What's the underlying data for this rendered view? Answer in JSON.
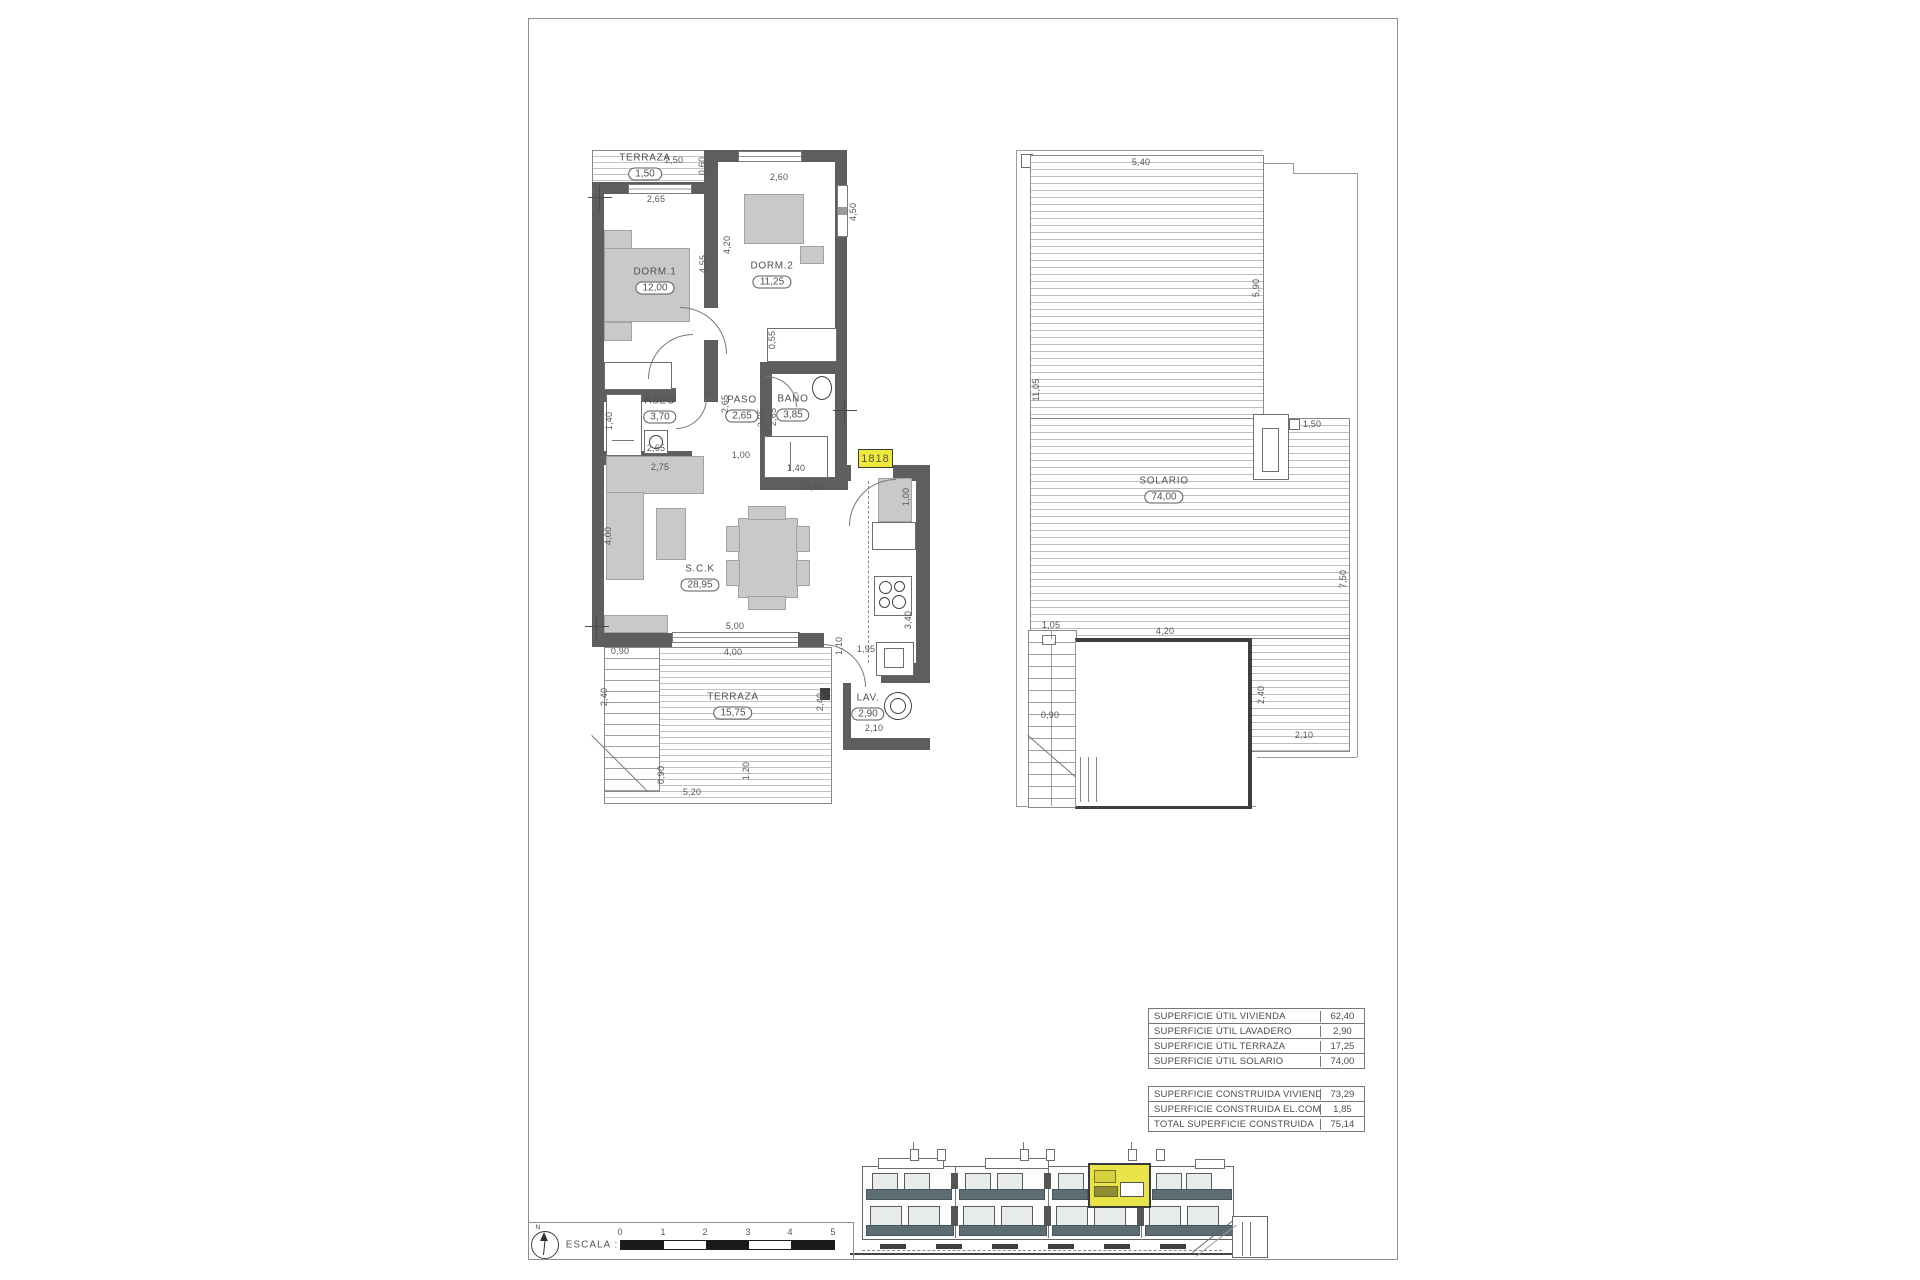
{
  "floor_plan": {
    "rooms": {
      "terraza_top": {
        "name": "TERRAZA",
        "area": "1,50"
      },
      "dorm1": {
        "name": "DORM.1",
        "area": "12,00"
      },
      "dorm2": {
        "name": "DORM.2",
        "area": "11,25"
      },
      "aseo": {
        "name": "ASEO",
        "area": "3,70"
      },
      "paso": {
        "name": "PASO",
        "area": "2,65"
      },
      "bano": {
        "name": "BAÑO",
        "area": "3,85"
      },
      "sck": {
        "name": "S.C.K",
        "area": "28,95"
      },
      "terraza_main": {
        "name": "TERRAZA",
        "area": "15,75"
      },
      "lav": {
        "name": "LAV.",
        "area": "2,90"
      }
    },
    "unit_badge": "1818",
    "dims": {
      "terraza_w": "2,50",
      "terraza_d": "0,60",
      "dorm1_window": "2,65",
      "dorm1_depth": "4,55",
      "dorm2_depth": "4,20",
      "dorm2_w": "2,60",
      "dorm2_h": "4,50",
      "wardrobe": "0,55",
      "aseo_w": "1,40",
      "aseo_inner": "2,65",
      "aseo_below": "2,75",
      "paso_v1": "2,65",
      "paso_v2": "3,05",
      "hall": "1,00",
      "bano_v": "2,65",
      "shower": "1,40",
      "bano_w": "3,50",
      "kitchen_top": "1,00",
      "kitchen_len": "3,40",
      "kitchen_end": "1,95",
      "sck_h": "4,00",
      "window": "5,00",
      "terraza_in": "4,00",
      "stair_w": "0,90",
      "stair_h": "2,40",
      "right_top": "1,10",
      "right_mid": "2,40",
      "bottom": "5,20",
      "bottom_left": "0,90",
      "bottom_v": "1,20",
      "lav_w": "2,10"
    }
  },
  "solarium": {
    "room": {
      "name": "SOLARIO",
      "area": "74,00"
    },
    "dims": {
      "top": "5,40",
      "left": "11,05",
      "right_upper": "5,90",
      "chimney": "1,50",
      "right_lower": "7,50",
      "stair_top": "1,05",
      "void_w": "4,20",
      "stair_mid": "0,90",
      "void_h": "2,40",
      "bottom_right": "2,10"
    }
  },
  "tables": {
    "util": {
      "rows": [
        {
          "label": "SUPERFICIE ÚTIL VIVIENDA",
          "value": "62,40"
        },
        {
          "label": "SUPERFICIE ÚTIL LAVADERO",
          "value": "2,90"
        },
        {
          "label": "SUPERFICIE ÚTIL TERRAZA",
          "value": "17,25"
        },
        {
          "label": "SUPERFICIE ÚTIL SOLARIO",
          "value": "74,00"
        }
      ]
    },
    "construida": {
      "rows": [
        {
          "label": "SUPERFICIE CONSTRUIDA VIVIENDA",
          "value": "73,29"
        },
        {
          "label": "SUPERFICIE CONSTRUIDA EL.COMUNES",
          "value": "1,85"
        },
        {
          "label": "TOTAL SUPERFICIE CONSTRUIDA",
          "value": "75,14"
        }
      ]
    }
  },
  "scale_bar": {
    "label": "ESCALA :",
    "north": "N",
    "ticks": [
      "0",
      "1",
      "2",
      "3",
      "4",
      "5"
    ]
  },
  "colors": {
    "highlight": "#efe93c",
    "wall": "#5e5e5e",
    "furniture": "#c9c9c9",
    "railing": "#5c6e74"
  }
}
